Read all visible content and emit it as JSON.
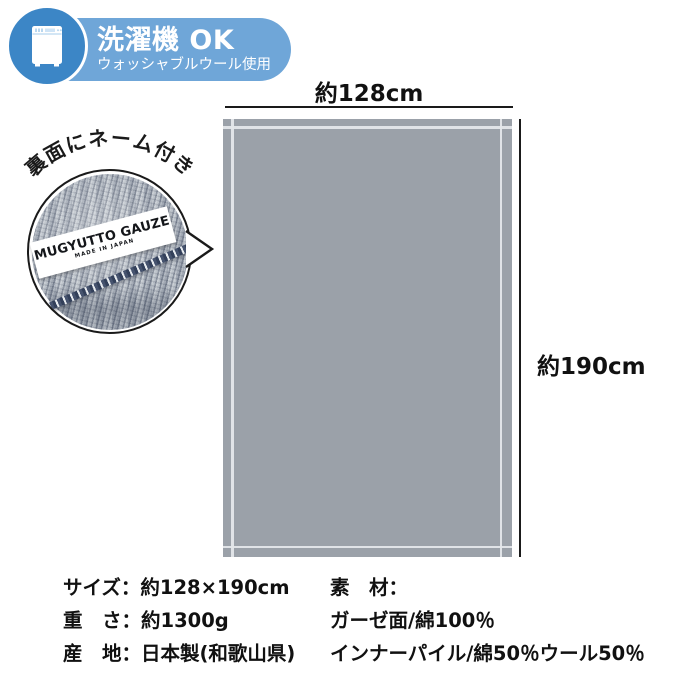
{
  "badge": {
    "title": "洗濯機 OK",
    "subtitle": "ウォッシャブルウール使用",
    "icon": "washing-machine"
  },
  "inset": {
    "caption": "裏面にネーム付き",
    "tag": {
      "line1": "MUGYUTTO GAUZE",
      "line2": "MADE IN JAPAN"
    }
  },
  "diagram": {
    "width_label": "約128cm",
    "height_label": "約190cm"
  },
  "specs": {
    "left": [
      "サイズ：約128×190cm",
      "重　さ：約1300g",
      "産　地：日本製(和歌山県)"
    ],
    "right": [
      "素　材：",
      "ガーゼ面/綿100％",
      "インナーパイル/綿50％ウール50％"
    ]
  },
  "colors": {
    "badge_pill": "#6FA6D8",
    "badge_circle": "#3C86C6",
    "blanket": "#9BA1A9",
    "hem_line": "#E4E7EA",
    "line": "#1A1A1A",
    "text": "#111111"
  }
}
